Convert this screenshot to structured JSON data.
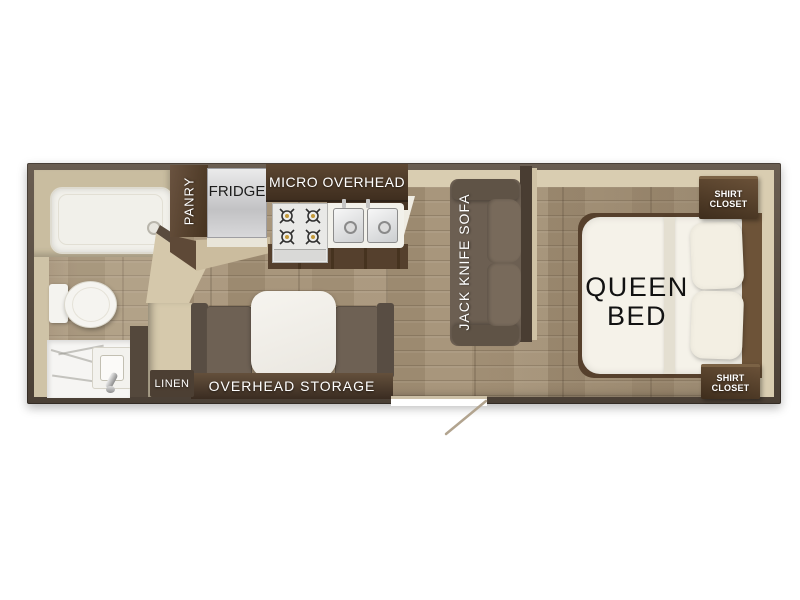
{
  "floorplan": {
    "labels": {
      "pantry": "PANRY",
      "fridge": "FRIDGE",
      "micro_overhead": "MICRO OVERHEAD",
      "overhead_storage": "OVERHEAD STORAGE",
      "linen": "LINEN",
      "sofa": "JACK KNIFE SOFA",
      "queen_bed": [
        "QUEEN",
        "BED"
      ],
      "shirt_closet": [
        "SHIRT",
        "CLOSET"
      ]
    },
    "colors": {
      "wall": "#554a40",
      "floor_wood": "#a59379",
      "interior_beige": "#d5c8ab",
      "cabinet_dark_wood": "#4e3a29",
      "upholstery_brown": "#6c5f52",
      "fixture_white": "#f3f1ea",
      "label_light": "#ffffff",
      "label_dark": "#1a1a1a"
    }
  }
}
